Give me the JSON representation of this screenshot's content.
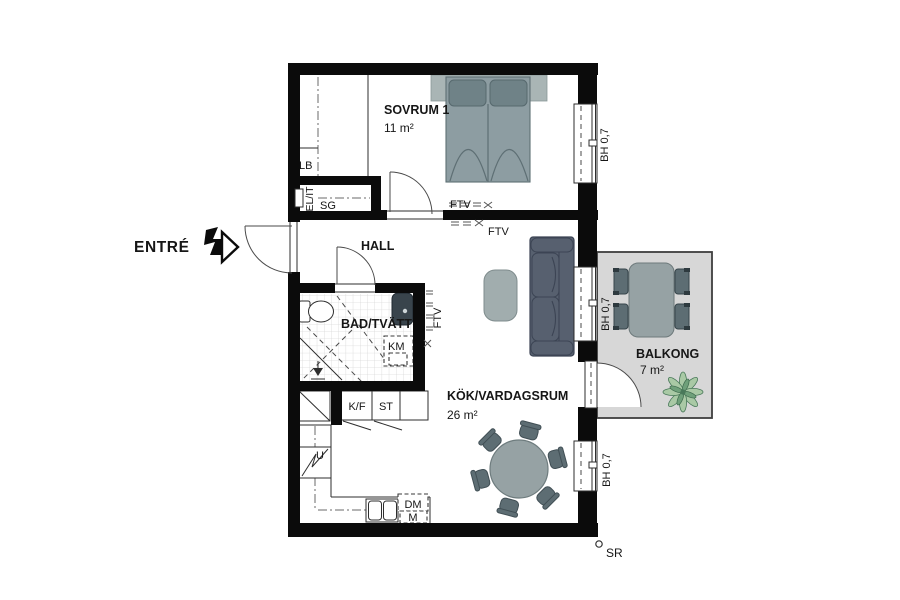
{
  "plan": {
    "entry_label": "ENTRÉ",
    "rooms": {
      "bedroom": {
        "name": "SOVRUM 1",
        "area": "11 m²"
      },
      "hall": {
        "name": "HALL"
      },
      "bathroom": {
        "name": "BAD/TVÄTT"
      },
      "kitchen_living": {
        "name": "KÖK/VARDAGSRUM",
        "area": "26 m²"
      },
      "balcony": {
        "name": "BALKONG",
        "area": "7 m²"
      }
    },
    "fixtures": {
      "lb": "LB",
      "el_it": "EL/IT",
      "sg": "SG",
      "km": "KM",
      "kf": "K/F",
      "st": "ST",
      "u": "U",
      "dm": "DM",
      "m": "M"
    },
    "annotations": {
      "ftv": "FTV",
      "bh07": "BH 0,7",
      "sr": "SR"
    },
    "colors": {
      "wall": "#0b0b0b",
      "bed_gray": "#8d9da2",
      "headboard_gray": "#a9b5b5",
      "pillow_gray": "#6f8287",
      "sofa_slate": "#57606f",
      "table_gray": "#96a2a4",
      "coffee_table_gray": "#a1adae",
      "chair_gray": "#5d6d73",
      "balcony_floor": "#d7d7d7",
      "plant_green": "#a9c9a5",
      "plant_dark_green": "#5d8a66",
      "basin_dark": "#39444c"
    }
  }
}
